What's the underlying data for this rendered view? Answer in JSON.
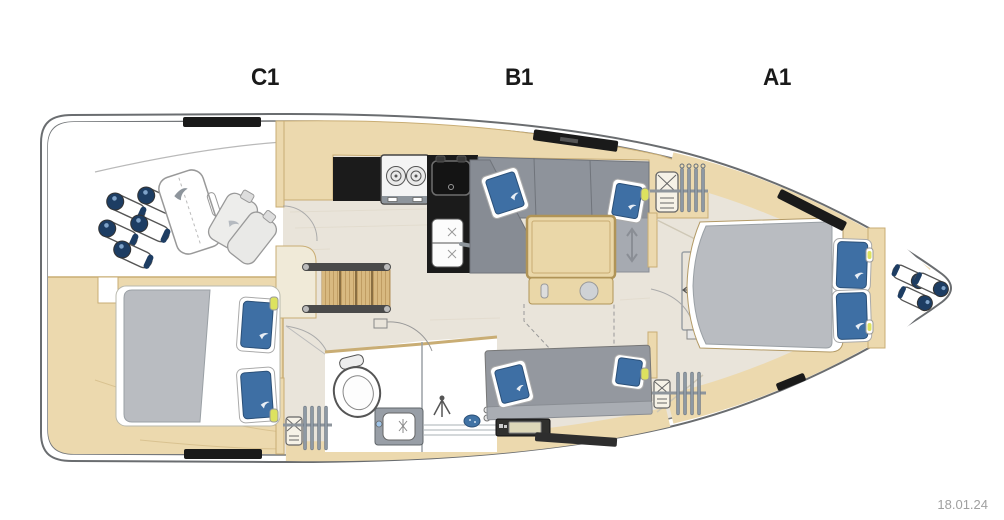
{
  "plan": {
    "type": "yacht-interior-floor-plan",
    "cabin_labels": [
      {
        "text": "C1"
      },
      {
        "text": "B1"
      },
      {
        "text": "A1"
      }
    ],
    "date_stamp": "18.01.24",
    "colors": {
      "background": "#ffffff",
      "hull_outline": "#6a6d70",
      "floor": "#e9e4da",
      "wood": "#ecd9ae",
      "wood_trim": "#c9ad74",
      "upholstery_gray": "#8e939b",
      "mattress_gray": "#b9bcc1",
      "pillow_blue": "#3e6fa4",
      "counter_black": "#1b1b1b",
      "fender_navy": "#1d3d63",
      "reading_light_yellow": "#dde25f",
      "label_text": "#1a1a1a",
      "date_text": "#a0a0a0"
    },
    "equipment_icons": [
      "fender-icon",
      "sail-bag-icon",
      "jerry-can-icon",
      "double-bed-icon",
      "pillow-icon",
      "reading-light-icon",
      "deck-hatch-icon",
      "stove-icon",
      "galley-sink-icon",
      "double-sink-icon",
      "companionway-steps-icon",
      "sofa-icon",
      "saloon-table-icon",
      "hanging-locker-icon",
      "hanger-icon",
      "toilet-icon",
      "vanity-sink-icon",
      "shower-icon",
      "drain-icon",
      "nav-instruments-icon",
      "door-swing-icon"
    ]
  }
}
